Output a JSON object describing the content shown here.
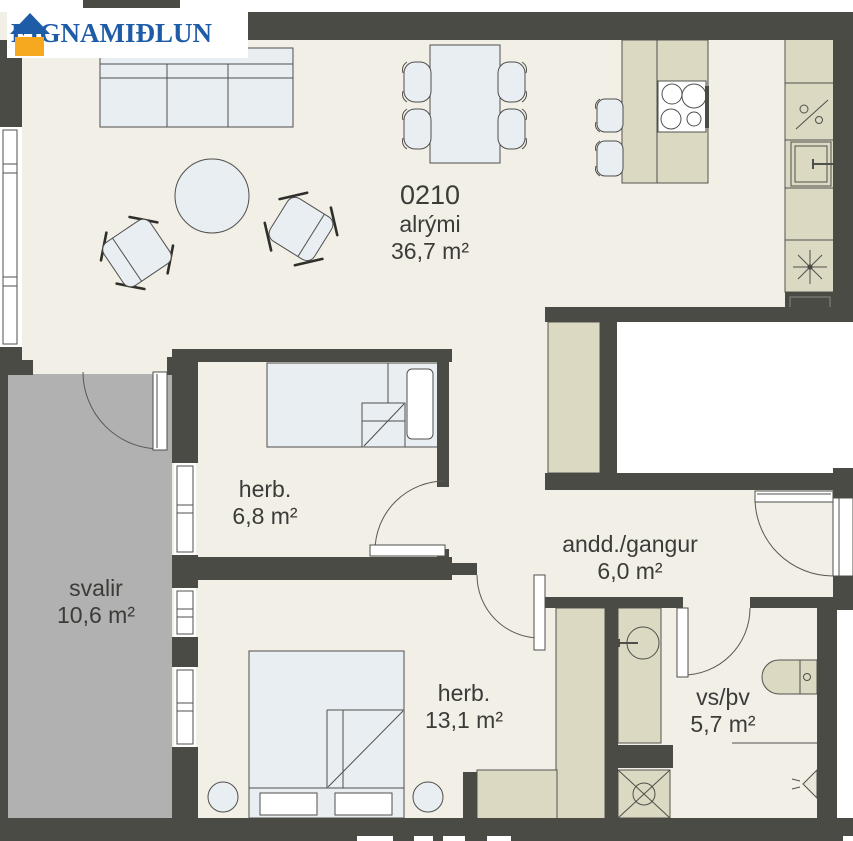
{
  "brand": {
    "name": "EIGNAMIÐLUN"
  },
  "plan": {
    "unit_number": "0210",
    "rooms": {
      "alrymi": {
        "name": "alrými",
        "area": "36,7 m²"
      },
      "herb_small": {
        "name": "herb.",
        "area": "6,8 m²"
      },
      "herb_large": {
        "name": "herb.",
        "area": "13,1 m²"
      },
      "svalir": {
        "name": "svalir",
        "area": "10,6 m²"
      },
      "gangur": {
        "name": "andd./gangur",
        "area": "6,0 m²"
      },
      "bath": {
        "name": "vs/þv",
        "area": "5,7 m²"
      }
    }
  },
  "colors": {
    "wall": "#4B4B46",
    "floor": "#F2EFE7",
    "cabinet": "#DCD9C3",
    "furniture": "#E9EEF3",
    "balcony": "#B1B1B1",
    "logo_blue": "#1E5CA8",
    "logo_orange": "#F6A81F",
    "text": "#3B3B38"
  }
}
